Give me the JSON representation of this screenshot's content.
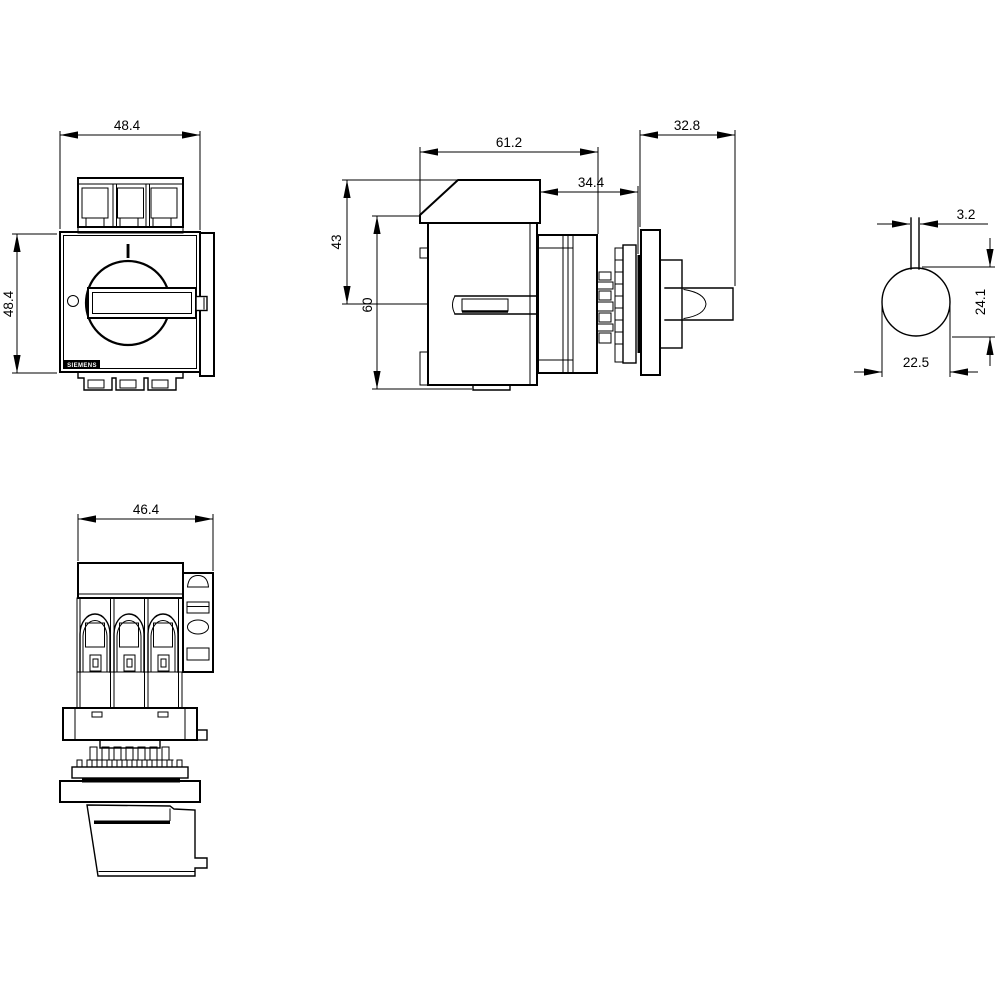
{
  "page": {
    "background": "#ffffff",
    "line_color": "#000000",
    "description": "Dimension drawing of a switch disconnector with rotary handle (dimensions in mm)"
  },
  "brand_label": "SIEMENS",
  "front_view": {
    "width": "48.4",
    "height": "48.4",
    "position_marking": "I"
  },
  "side_view": {
    "depth": "61.2",
    "rear_depth": "34.4",
    "upper_height": "43",
    "overall_height": "60",
    "handle_projection": "32.8"
  },
  "handle_section_view": {
    "blade_thickness": "3.2",
    "height": "24.1",
    "diameter": "22.5"
  },
  "bottom_view": {
    "width": "46.4"
  }
}
